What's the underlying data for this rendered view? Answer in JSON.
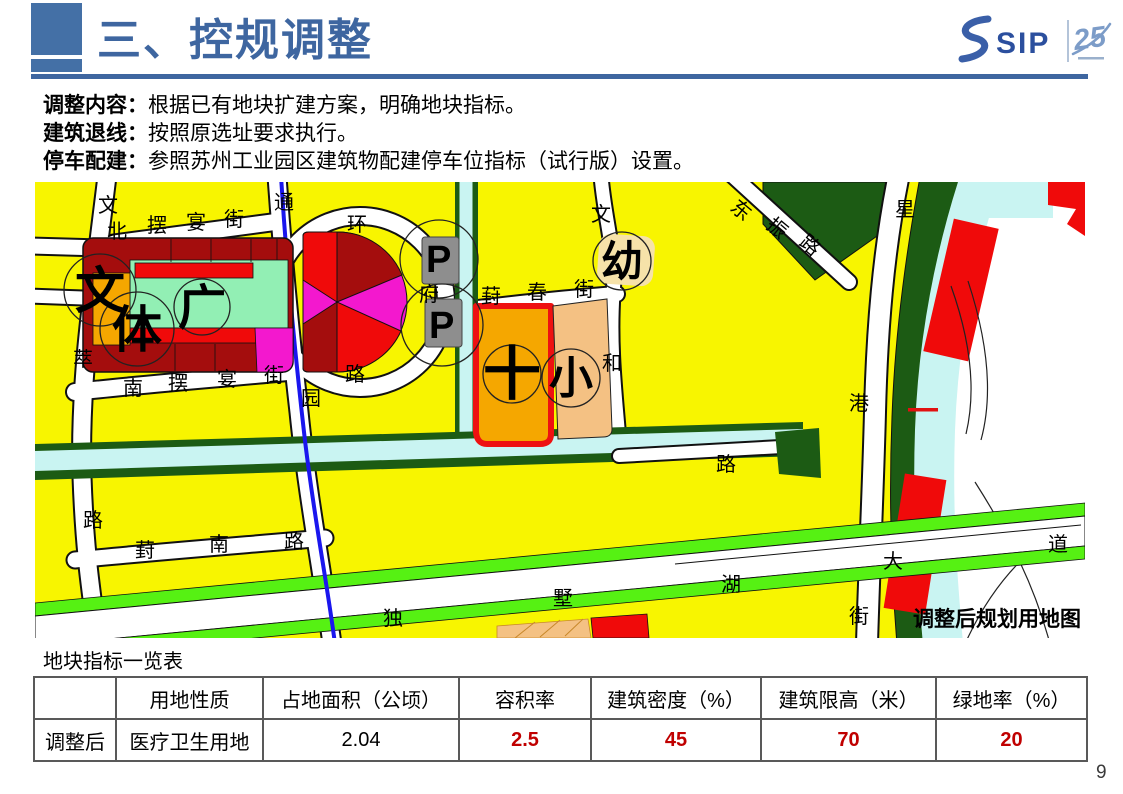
{
  "header": {
    "title": "三、控规调整"
  },
  "logo": {
    "brand": "SIP",
    "anniversary": "25"
  },
  "content": {
    "lines": [
      {
        "label": "调整内容：",
        "text": "根据已有地块扩建方案，明确地块指标。"
      },
      {
        "label": "建筑退线：",
        "text": "按照原选址要求执行。"
      },
      {
        "label": "停车配建：",
        "text": "参照苏州工业园区建筑物配建停车位指标（试行版）设置。"
      }
    ]
  },
  "map": {
    "caption": "调整后规划用地图",
    "labels": [
      {
        "t": "文",
        "x": 63,
        "y": 30
      },
      {
        "t": "北",
        "x": 72,
        "y": 56
      },
      {
        "t": "摆",
        "x": 112,
        "y": 50
      },
      {
        "t": "宴",
        "x": 151,
        "y": 47
      },
      {
        "t": "街",
        "x": 189,
        "y": 44
      },
      {
        "t": "通",
        "x": 239,
        "y": 27
      },
      {
        "t": "环",
        "x": 312,
        "y": 49
      },
      {
        "t": "府",
        "x": 384,
        "y": 119
      },
      {
        "t": "路",
        "x": 310,
        "y": 199
      },
      {
        "t": "园",
        "x": 266,
        "y": 223
      },
      {
        "t": "萃",
        "x": 38,
        "y": 184
      },
      {
        "t": "路",
        "x": 48,
        "y": 345
      },
      {
        "t": "南",
        "x": 88,
        "y": 213
      },
      {
        "t": "摆",
        "x": 133,
        "y": 208
      },
      {
        "t": "宴",
        "x": 182,
        "y": 204
      },
      {
        "t": "街",
        "x": 229,
        "y": 200
      },
      {
        "t": "葑",
        "x": 446,
        "y": 121
      },
      {
        "t": "春",
        "x": 492,
        "y": 117
      },
      {
        "t": "街",
        "x": 539,
        "y": 114
      },
      {
        "t": "文",
        "x": 556,
        "y": 39
      },
      {
        "t": "和",
        "x": 567,
        "y": 188
      },
      {
        "t": "路",
        "x": 681,
        "y": 289
      },
      {
        "t": "东",
        "x": 694,
        "y": 27,
        "r": 40
      },
      {
        "t": "振",
        "x": 730,
        "y": 45,
        "r": 40
      },
      {
        "t": "路",
        "x": 763,
        "y": 62,
        "r": 40
      },
      {
        "t": "星",
        "x": 860,
        "y": 34
      },
      {
        "t": "港",
        "x": 814,
        "y": 228
      },
      {
        "t": "街",
        "x": 814,
        "y": 441
      },
      {
        "t": "葑",
        "x": 100,
        "y": 375
      },
      {
        "t": "南",
        "x": 174,
        "y": 369
      },
      {
        "t": "路",
        "x": 249,
        "y": 366
      },
      {
        "t": "独",
        "x": 348,
        "y": 443
      },
      {
        "t": "墅",
        "x": 518,
        "y": 423
      },
      {
        "t": "湖",
        "x": 686,
        "y": 409
      },
      {
        "t": "大",
        "x": 848,
        "y": 386
      },
      {
        "t": "道",
        "x": 1013,
        "y": 369
      },
      {
        "t": "文",
        "x": 40,
        "y": 126,
        "s": 50,
        "b": 1
      },
      {
        "t": "体",
        "x": 77,
        "y": 165,
        "s": 50,
        "b": 1
      },
      {
        "t": "广",
        "x": 143,
        "y": 142,
        "s": 48,
        "b": 1
      },
      {
        "t": "P",
        "x": 391,
        "y": 90,
        "s": 38,
        "b": 1
      },
      {
        "t": "P",
        "x": 394,
        "y": 156,
        "s": 38,
        "b": 1
      },
      {
        "t": "十",
        "x": 448,
        "y": 212,
        "s": 58,
        "b": 1
      },
      {
        "t": "小",
        "x": 514,
        "y": 211,
        "s": 44,
        "b": 1
      },
      {
        "t": "幼",
        "x": 566,
        "y": 94,
        "s": 42,
        "b": 1
      }
    ]
  },
  "table": {
    "caption": "地块指标一览表",
    "headers": [
      "",
      "用地性质",
      "占地面积（公顷）",
      "容积率",
      "建筑密度（%）",
      "建筑限高（米）",
      "绿地率（%）"
    ],
    "row": {
      "label": "调整后",
      "land_use": "医疗卫生用地",
      "area": "2.04",
      "far": "2.5",
      "density": "45",
      "height_limit": "70",
      "green_ratio": "20"
    }
  },
  "footer": {
    "page": "9"
  },
  "colors": {
    "accent_blue": "#3E66A0",
    "logo_blue": "#2B4F9E",
    "logo_light_blue": "#7C9CC8",
    "highlight_red": "#C00000",
    "map": {
      "yellow": "#F8F500",
      "dark_red": "#A40D0D",
      "red": "#F00A0A",
      "magenta": "#F318CE",
      "mint": "#92EFB4",
      "orange": "#F5A700",
      "tan": "#F4C183",
      "cream": "#F6E2A9",
      "parking_gray": "#8E8E8E",
      "canal_cyan": "#C9F4F2",
      "park_green": "#1C5B14",
      "roadside_green": "#56F113",
      "metro_blue": "#1A16EE"
    }
  }
}
